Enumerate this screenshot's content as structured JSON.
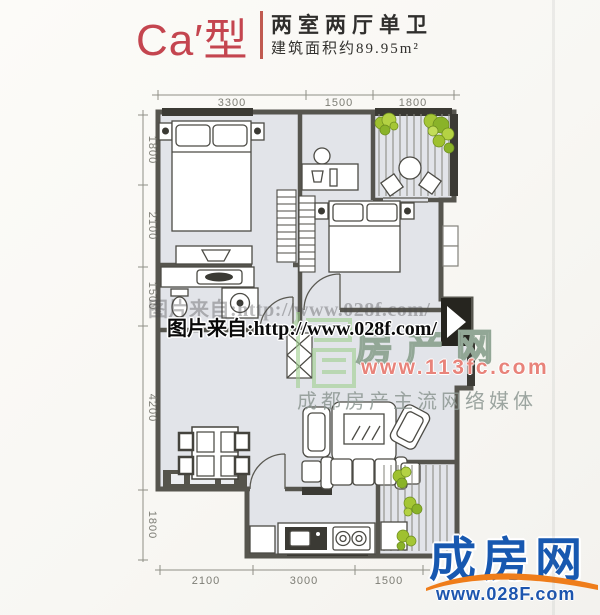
{
  "header": {
    "type_label": "Ca′型",
    "title": "两室两厅单卫",
    "area": "建筑面积约89.95m²"
  },
  "dimensions": {
    "top": [
      "3300",
      "1500",
      "1800"
    ],
    "left": [
      "1800",
      "2100",
      "1500",
      "4200",
      "1800"
    ],
    "bottom": [
      "2100",
      "3000",
      "1500"
    ]
  },
  "watermarks": {
    "ghost_text": "图片来自:http://www.028f.com/",
    "main_text": "图片来自:http://www.028f.com/",
    "portal_name": "房产网",
    "portal_url": "www.113fc.com",
    "portal_slogan": "成都房产主流网络媒体"
  },
  "footer_logo": {
    "name": "成房网",
    "url": "www.028F.com"
  },
  "colors": {
    "accent_red": "#c4454f",
    "wall_dark": "#56554e",
    "window_dark": "#3b3a34",
    "floor_fill": "#e2e4e9",
    "plant_green": "#a5c636",
    "logo_blue": "#1758b0",
    "logo_orange": "#ef7d1a",
    "watermark_red": "#e8837a"
  }
}
